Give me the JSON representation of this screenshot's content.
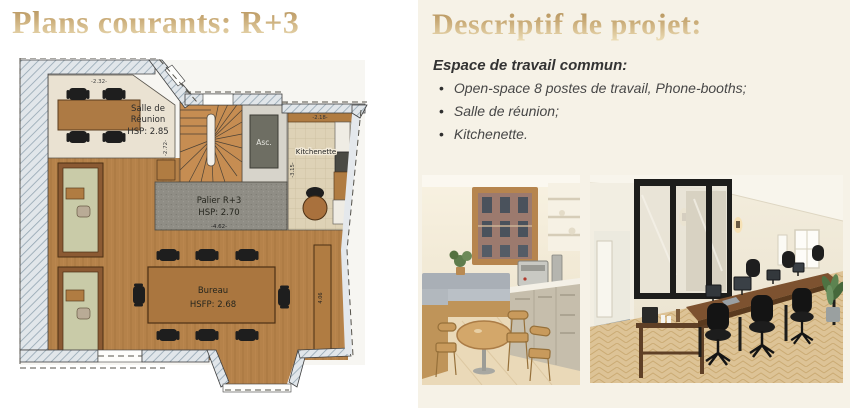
{
  "slide": {
    "left": {
      "title": "Plans courants: R+3",
      "plan": {
        "rooms": {
          "salle_reunion": {
            "name_line1": "Salle de",
            "name_line2": "Réunion",
            "height": "HSP: 2.85"
          },
          "palier": {
            "name": "Palier R+3",
            "height": "HSP: 2.70"
          },
          "bureau": {
            "name": "Bureau",
            "height": "HSFP: 2.68"
          },
          "kitchenette": {
            "name": "Kitchenette"
          },
          "elevator": {
            "name": "Asc."
          }
        },
        "dimensions": {
          "salle_width": "-2.32-",
          "salle_depth": "-2.72-",
          "kitchenette_width": "-2.18-",
          "kitchenette_depth": "-3.15-",
          "palier_width": "-4.62-",
          "bureau_width": "-8.75-",
          "bureau_side": "4.06"
        }
      }
    },
    "right": {
      "title": "Descriptif de projet:",
      "description": {
        "heading": "Espace de travail commun:",
        "bullet_glyph": "•",
        "bullets": [
          "Open-space 8 postes de travail, Phone-booths;",
          "Salle de réunion;",
          "Kitchenette."
        ]
      },
      "photos": [
        {
          "name": "kitchenette-photo",
          "alt": "Coin kitchenette avec banquette, table ronde et machine à café"
        },
        {
          "name": "open-space-photo",
          "alt": "Open-space avec verrière, grande table partagée et chaises de bureau"
        }
      ]
    },
    "colors": {
      "accent_gold": "#c3a46c",
      "panel_cream": "#f6f2e7"
    }
  }
}
